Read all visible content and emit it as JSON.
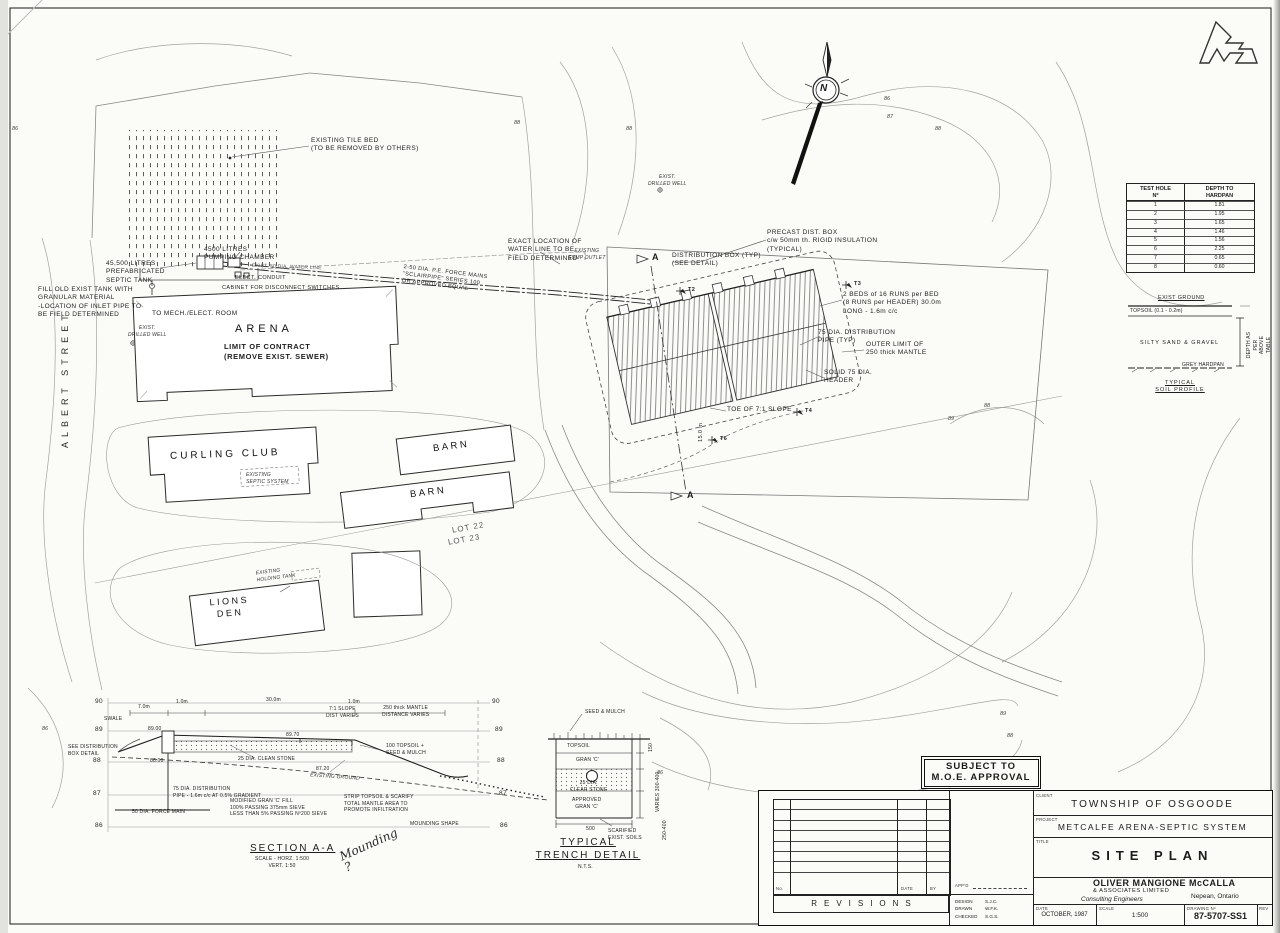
{
  "plan": {
    "tile_bed": "EXISTING TILE BED\n(TO BE REMOVED BY OTHERS)",
    "sump_outlet": "EXISTING\nSUMP OUTLET",
    "limit_contract": "LIMIT OF CONTRACT\n(REMOVE EXIST. SEWER)",
    "pump_chamber": "4500 LITRES\nPUMPING CHAMBER",
    "septic_tank": "45,500 LITRES\nPREFABRICATED\nSEPTIC TANK",
    "fill_tank": "FILL OLD EXIST TANK WITH\nGRANULAR MATERIAL\n-LOCATION OF INLET PIPE TO\nBE FIELD DETERMINED",
    "water_line_exact": "EXACT LOCATION OF\nWATER LINE TO BE\nFIELD DETERMINED",
    "exist_water": "EXIST. 50 DIA. WATER LINE",
    "elect_conduit": "ELECT. CONDUIT",
    "cabinet": "CABINET FOR DISCONNECT SWITCHES",
    "to_mech": "TO MECH./ELECT. ROOM",
    "well": "EXIST.\nDRILLED WELL",
    "arena": "ARENA",
    "street": "ALBERT STREET",
    "force_mains": "2-50 DIA. P.E. FORCE MAINS\n\"SCLAIRPIPE\" SERIES 100\nOR APPROVED EQUAL",
    "precast_box": "PRECAST DIST. BOX\nc/w 50mm th. RIGID INSULATION\n(TYPICAL)",
    "dist_box": "DISTRIBUTION BOX (TYP)\n(SEE DETAIL)",
    "beds_note": "2 BEDS of 16 RUNS per BED\n(8 RUNS per HEADER) 30.0m\nLONG - 1.6m c/c",
    "dist_pipe": "75 DIA. DISTRIBUTION\nPIPE (TYP)",
    "outer_limit": "OUTER LIMIT OF\n250 thick MANTLE",
    "solid_header": "SOLID 75 DIA.\nHEADER",
    "toe_slope": "TOE OF 7:1 SLOPE",
    "dim_15m": "15.0 m",
    "section_marker": "A",
    "t2": "T2",
    "t3": "T3",
    "t4": "T4",
    "t6": "T6",
    "curling": "CURLING CLUB",
    "exist_septic": "EXISTING\nSEPTIC SYSTEM",
    "barn": "BARN",
    "lot22": "LOT 22",
    "lot23": "LOT 23",
    "lions": "LIONS\nDEN",
    "holding_tank": "EXISTING\nHOLDING TANK",
    "north_n": "N"
  },
  "contour_labels": [
    {
      "t": "86",
      "x": 884,
      "y": 96
    },
    {
      "t": "87",
      "x": 887,
      "y": 114
    },
    {
      "t": "88",
      "x": 935,
      "y": 126
    },
    {
      "t": "88",
      "x": 514,
      "y": 120
    },
    {
      "t": "86",
      "x": 12,
      "y": 126
    },
    {
      "t": "88",
      "x": 626,
      "y": 126
    },
    {
      "t": "88",
      "x": 984,
      "y": 403
    },
    {
      "t": "89",
      "x": 948,
      "y": 416
    },
    {
      "t": "89",
      "x": 1000,
      "y": 711
    },
    {
      "t": "88",
      "x": 1007,
      "y": 733
    },
    {
      "t": "87",
      "x": 1012,
      "y": 756
    },
    {
      "t": "86",
      "x": 657,
      "y": 770
    },
    {
      "t": "86",
      "x": 42,
      "y": 726
    }
  ],
  "test_holes": {
    "h1a": "TEST HOLE",
    "h1b": "Nº",
    "h2a": "DEPTH TO",
    "h2b": "HARDPAN",
    "rows": [
      [
        "1",
        "1.81"
      ],
      [
        "2",
        "1.95"
      ],
      [
        "3",
        "1.65"
      ],
      [
        "4",
        "1.46"
      ],
      [
        "5",
        "1.56"
      ],
      [
        "6",
        "2.25"
      ],
      [
        "7",
        "0.65"
      ],
      [
        "8",
        "0.60"
      ]
    ]
  },
  "soil": {
    "exist_ground": "EXIST GROUND",
    "topsoil": "TOPSOIL (0.1 - 0.2m)",
    "silty": "SILTY SAND & GRAVEL",
    "hardpan": "GREY HARDPAN",
    "depth_note": "DEPTH AS PER\nABOVE TABLE",
    "title": "TYPICAL\nSOIL PROFILE"
  },
  "section": {
    "title": "SECTION A-A",
    "scale": "SCALE - HORZ. 1:500\nVERT. 1:50",
    "swale": "SWALE",
    "see_dist": "SEE DISTRIBUTION\nBOX DETAIL",
    "dim_7m": "7.0m",
    "dim_1m_a": "1.0m",
    "dim_30m": "30.0m",
    "dim_1m_b": "1.0m",
    "slope_note": "7:1 SLOPE\nDIST VARIES",
    "mantle_note": "250 thick MANTLE\nDISTANCE VARIES",
    "el_8900": "89.00",
    "el_8800": "88.00",
    "el_8970": "89.70",
    "el_8720": "87.20",
    "clean_stone": "25 DIA. CLEAN STONE",
    "dist_pipe_note": "75 DIA. DISTRIBUTION\nPIPE - 1.6m c/c AT 0.5% GRADIENT",
    "force_main": "50 DIA. FORCE MAIN",
    "gran_fill": "MODIFIED GRAN 'C' FILL\n100% PASSING 375mm SIEVE\nLESS THAN 5% PASSING Nº200 SIEVE",
    "topsoil_seed": "100 TOPSOIL +\nSEED & MULCH",
    "exist_ground": "EXISTING GROUND",
    "strip_topsoil": "STRIP TOPSOIL & SCARIFY\nTOTAL MANTLE AREA TO\nPROMOTE INFILTRATION",
    "mounding_shape": "MOUNDING SHAPE",
    "handwritten": "Mounding\n?",
    "elev_left": [
      "90",
      "89",
      "88",
      "87",
      "86"
    ],
    "elev_right": [
      "90",
      "89",
      "88",
      "87",
      "86"
    ]
  },
  "trench": {
    "seed": "SEED & MULCH",
    "topsoil": "TOPSOIL",
    "gran": "GRAN 'C'",
    "stone": "25 DIA.\nCLEAR STONE",
    "approved": "APPROVED\nGRAN 'C'",
    "dim_500": "500",
    "scarified": "SCARIFIED\nEXIST. SOILS",
    "dim_150": "150",
    "dim_varies": "VARIES 300-400",
    "dim_250": "250-400",
    "title": "TYPICAL\nTRENCH DETAIL",
    "nts": "N.T.S."
  },
  "moe": {
    "line1": "SUBJECT TO",
    "line2": "M.O.E. APPROVAL"
  },
  "title_block": {
    "revisions": "REVISIONS",
    "col_no": "No.",
    "col_date": "DATE",
    "col_by": "BY",
    "appd": "APP'D",
    "design_label": "DESIGN",
    "design": "S.J.C.",
    "drawn_label": "DRAWN",
    "drawn": "W.F.K.",
    "checked_label": "CHECKED",
    "checked": "S.G.S.",
    "client_label": "CLIENT",
    "client": "TOWNSHIP OF OSGOODE",
    "project_label": "PROJECT",
    "project": "METCALFE ARENA-SEPTIC SYSTEM",
    "title_label": "TITLE",
    "title": "SITE PLAN",
    "firm_name": "OLIVER MANGIONE McCALLA",
    "firm_sub": "& ASSOCIATES LIMITED",
    "firm_type": "Consulting Engineers",
    "firm_city": "Nepean, Ontario",
    "date_label": "DATE",
    "date": "OCTOBER, 1987",
    "scale_label": "SCALE",
    "scale": "1:500",
    "drawing_label": "DRAWING Nº",
    "drawing_no": "87-5707-SS1",
    "rev_label": "REV"
  }
}
